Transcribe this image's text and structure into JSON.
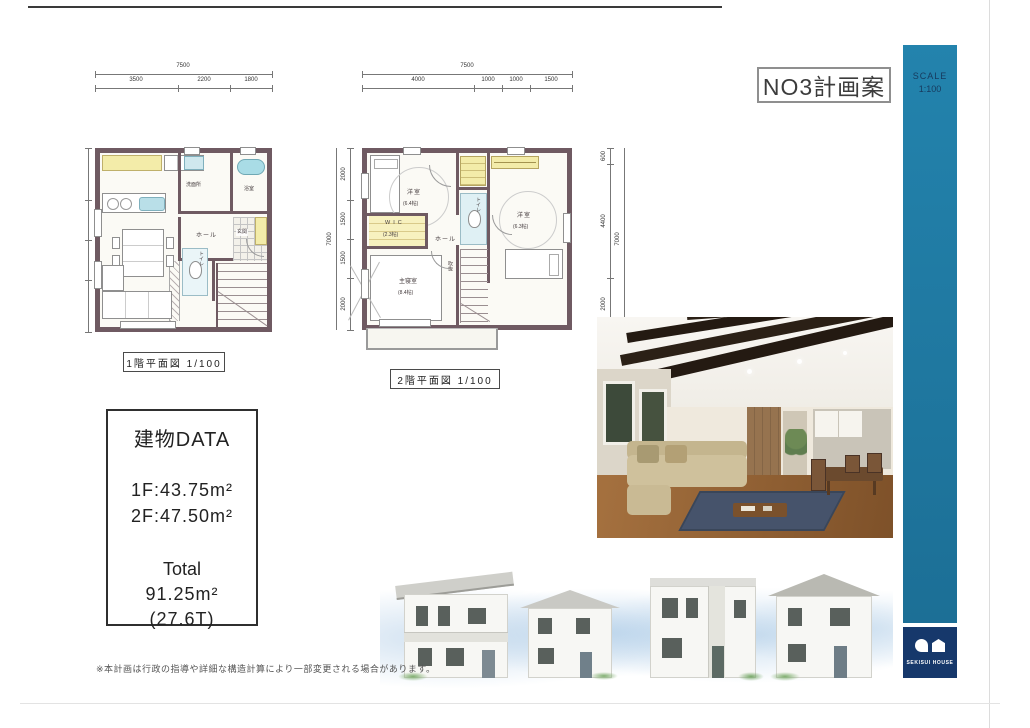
{
  "page": {
    "title": "NO3計画案",
    "scale_label": "SCALE",
    "scale_value": "1:100",
    "brand": "SEKISUI HOUSE",
    "footer_note": "※本計画は行政の指導や詳細な構造計算により一部変更される場合があります。"
  },
  "colors": {
    "accent_teal": "#1f7aa3",
    "brand_navy": "#16386b",
    "wall": "#6f5a62",
    "closet_yellow": "#f3eca9",
    "wet_blue": "#b9dfe8"
  },
  "plan_1f": {
    "caption": "1階平面図 1/100",
    "dims_top": {
      "total": "7500",
      "segments": [
        "3500",
        "2200",
        "1800"
      ]
    },
    "rooms": {
      "washroom": "洗面所",
      "bath": "浴室",
      "hall": "ホール",
      "entrance": "玄関",
      "ldk": "LDK",
      "ldk_size": "(16.4帖)",
      "toilet": "トイレ",
      "void_above": "上部吹抜"
    }
  },
  "plan_2f": {
    "caption": "2階平面図 1/100",
    "dims_top": {
      "total": "7500",
      "segments": [
        "4000",
        "1000",
        "1000",
        "1500"
      ]
    },
    "dims_left": {
      "total": "7000",
      "segments": [
        "2000",
        "1500",
        "1500",
        "2000"
      ]
    },
    "dims_right": {
      "total": "7000",
      "segments": [
        "600",
        "4400",
        "2000"
      ]
    },
    "rooms": {
      "bedroom1": "洋室",
      "bedroom1_size": "(6.4帖)",
      "wic": "WIC",
      "wic_size": "(2.3帖)",
      "toilet": "トイレ",
      "hall": "ホール",
      "bedroom2": "洋室",
      "bedroom2_size": "(6.3帖)",
      "master_bedroom": "主寝室",
      "master_bedroom_size": "(8.4帖)",
      "void": "吹抜"
    }
  },
  "building_data": {
    "title": "建物DATA",
    "floor_1": "1F:43.75m²",
    "floor_2": "2F:47.50m²",
    "total_label": "Total",
    "total_area": "91.25m²",
    "total_tsubo": "(27.6T)"
  }
}
